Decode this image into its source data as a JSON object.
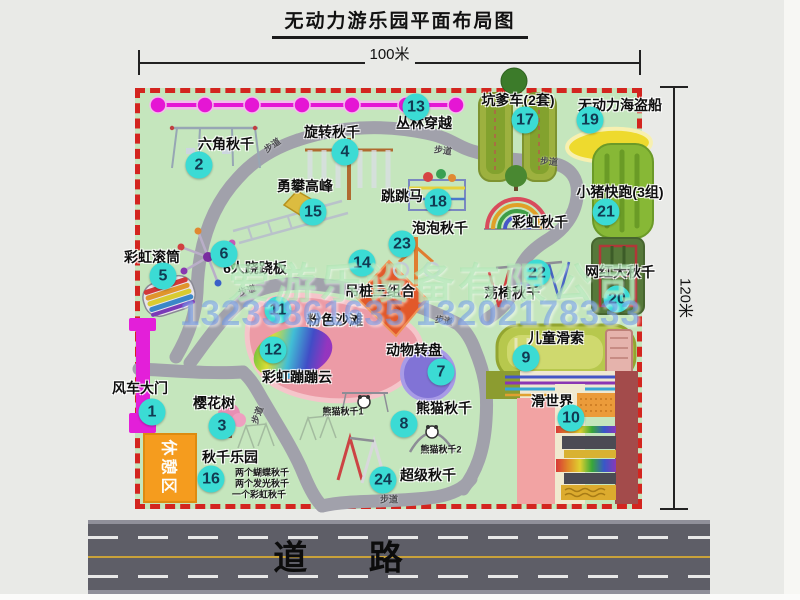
{
  "title": "无动力游乐园平面布局图",
  "dimensions": {
    "width": "100米",
    "height": "120米"
  },
  "road_label": "道 路",
  "rest_area_label": "休憩区",
  "watermark": {
    "company": "爱游乐设备有限公司",
    "phone": "13233861635 13202178333"
  },
  "walkway": {
    "text": "步道",
    "positions": [
      [
        272,
        145,
        -35
      ],
      [
        443,
        150,
        8
      ],
      [
        549,
        161,
        5
      ],
      [
        247,
        290,
        -18
      ],
      [
        257,
        415,
        -70
      ],
      [
        444,
        320,
        10
      ],
      [
        389,
        499,
        0
      ]
    ]
  },
  "colors": {
    "park_green": "#c5e6bd",
    "border_red": "#d3251f",
    "badge_cyan": "#3bdbd4",
    "gate_magenta": "#e31fd9",
    "road_gray": "#5e5e67",
    "rest_orange": "#f59c1e",
    "chain_magenta": "#e516d4",
    "path_gray": "#a1a1ab"
  },
  "attractions": [
    {
      "num": "1",
      "name": "风车大门",
      "label": [
        140,
        388
      ],
      "badge": [
        152,
        412
      ]
    },
    {
      "num": "2",
      "name": "六角秋千",
      "label": [
        226,
        144
      ],
      "badge": [
        199,
        165
      ]
    },
    {
      "num": "3",
      "name": "樱花树",
      "label": [
        214,
        403
      ],
      "badge": [
        222,
        426
      ]
    },
    {
      "num": "4",
      "name": "旋转秋千",
      "label": [
        332,
        132
      ],
      "badge": [
        345,
        152
      ]
    },
    {
      "num": "5",
      "name": "彩虹滚筒",
      "label": [
        152,
        257
      ],
      "badge": [
        163,
        276
      ]
    },
    {
      "num": "6",
      "name": "6人跷跷板",
      "label": [
        255,
        268
      ],
      "badge": [
        224,
        254
      ]
    },
    {
      "num": "7",
      "name": "动物转盘",
      "label": [
        414,
        350
      ],
      "badge": [
        441,
        372
      ]
    },
    {
      "num": "8",
      "name": "熊猫秋千",
      "label": [
        444,
        408
      ],
      "badge": [
        404,
        424
      ],
      "subs": [
        {
          "text": "熊猫秋千1",
          "pos": [
            343,
            411
          ]
        },
        {
          "text": "熊猫秋千2",
          "pos": [
            441,
            449
          ]
        }
      ]
    },
    {
      "num": "9",
      "name": "儿童滑索",
      "label": [
        556,
        338
      ],
      "badge": [
        526,
        358
      ]
    },
    {
      "num": "10",
      "name": "滑世界",
      "label": [
        552,
        401
      ],
      "badge": [
        571,
        418
      ]
    },
    {
      "num": "11",
      "name": "粉色沙滩",
      "label": [
        335,
        320
      ],
      "badge": [
        278,
        310
      ]
    },
    {
      "num": "12",
      "name": "彩虹蹦蹦云",
      "label": [
        297,
        377
      ],
      "badge": [
        273,
        350
      ]
    },
    {
      "num": "13",
      "name": "丛林穿越",
      "label": [
        424,
        123
      ],
      "badge": [
        416,
        107
      ]
    },
    {
      "num": "14",
      "name": "吊桩三组合",
      "label": [
        380,
        291
      ],
      "badge": [
        362,
        263
      ]
    },
    {
      "num": "15",
      "name": "勇攀高峰",
      "label": [
        305,
        186
      ],
      "badge": [
        313,
        212
      ]
    },
    {
      "num": "16",
      "name": "秋千乐园",
      "label": [
        230,
        457
      ],
      "badge": [
        211,
        479
      ],
      "subs": [
        {
          "text": "两个蝴蝶秋千",
          "pos": [
            262,
            472
          ]
        },
        {
          "text": "两个发光秋千",
          "pos": [
            262,
            483
          ]
        },
        {
          "text": "一个彩虹秋千",
          "pos": [
            259,
            494
          ]
        }
      ]
    },
    {
      "num": "17",
      "name": "坑爹车(2套)",
      "label": [
        518,
        100
      ],
      "badge": [
        525,
        120
      ]
    },
    {
      "num": "18",
      "name": "跳跳马",
      "label": [
        402,
        196
      ],
      "badge": [
        438,
        202
      ]
    },
    {
      "num": "19",
      "name": "无动力海盗船",
      "label": [
        620,
        105
      ],
      "badge": [
        590,
        120
      ]
    },
    {
      "num": "20",
      "name": "网红大秋千",
      "label": [
        620,
        272
      ],
      "badge": [
        617,
        299
      ]
    },
    {
      "num": "21",
      "name": "小猪快跑(3组)",
      "label": [
        620,
        192
      ],
      "badge": [
        606,
        212
      ]
    },
    {
      "num": "22",
      "name": "荡椅秋千",
      "label": [
        512,
        293
      ],
      "badge": [
        537,
        273
      ]
    },
    {
      "num": "23",
      "name": "泡泡秋千",
      "label": [
        440,
        228
      ],
      "badge": [
        402,
        244
      ]
    },
    {
      "num": "24",
      "name": "超级秋千",
      "label": [
        428,
        475
      ],
      "badge": [
        383,
        480
      ]
    },
    {
      "num": null,
      "name": "彩虹秋千",
      "label": [
        540,
        222
      ],
      "badge": null
    }
  ]
}
